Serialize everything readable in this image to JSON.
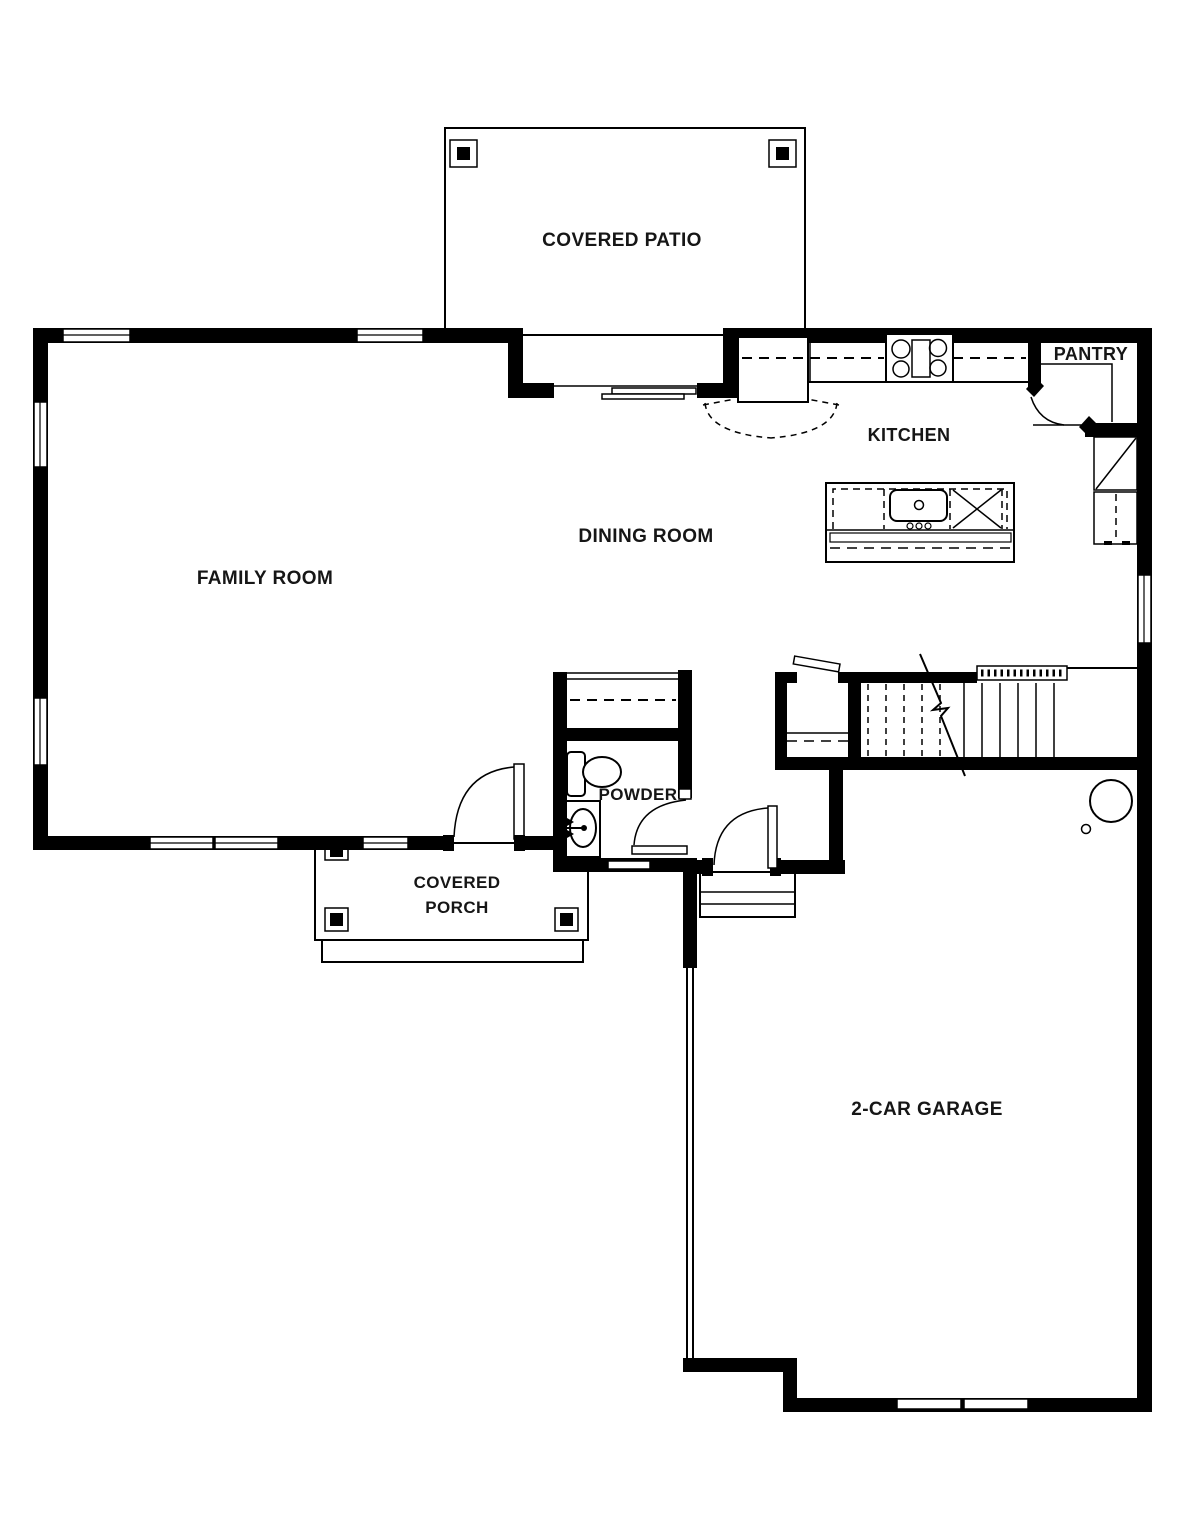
{
  "plan": {
    "background": "#ffffff",
    "line_color": "#000000",
    "text_color": "#161616",
    "rooms": {
      "covered_patio": "COVERED PATIO",
      "kitchen": "KITCHEN",
      "pantry": "PANTRY",
      "dining_room": "DINING ROOM",
      "family_room": "FAMILY ROOM",
      "powder": "POWDER",
      "porch_line1": "COVERED",
      "porch_line2": "PORCH",
      "garage": "2-CAR GARAGE"
    }
  }
}
